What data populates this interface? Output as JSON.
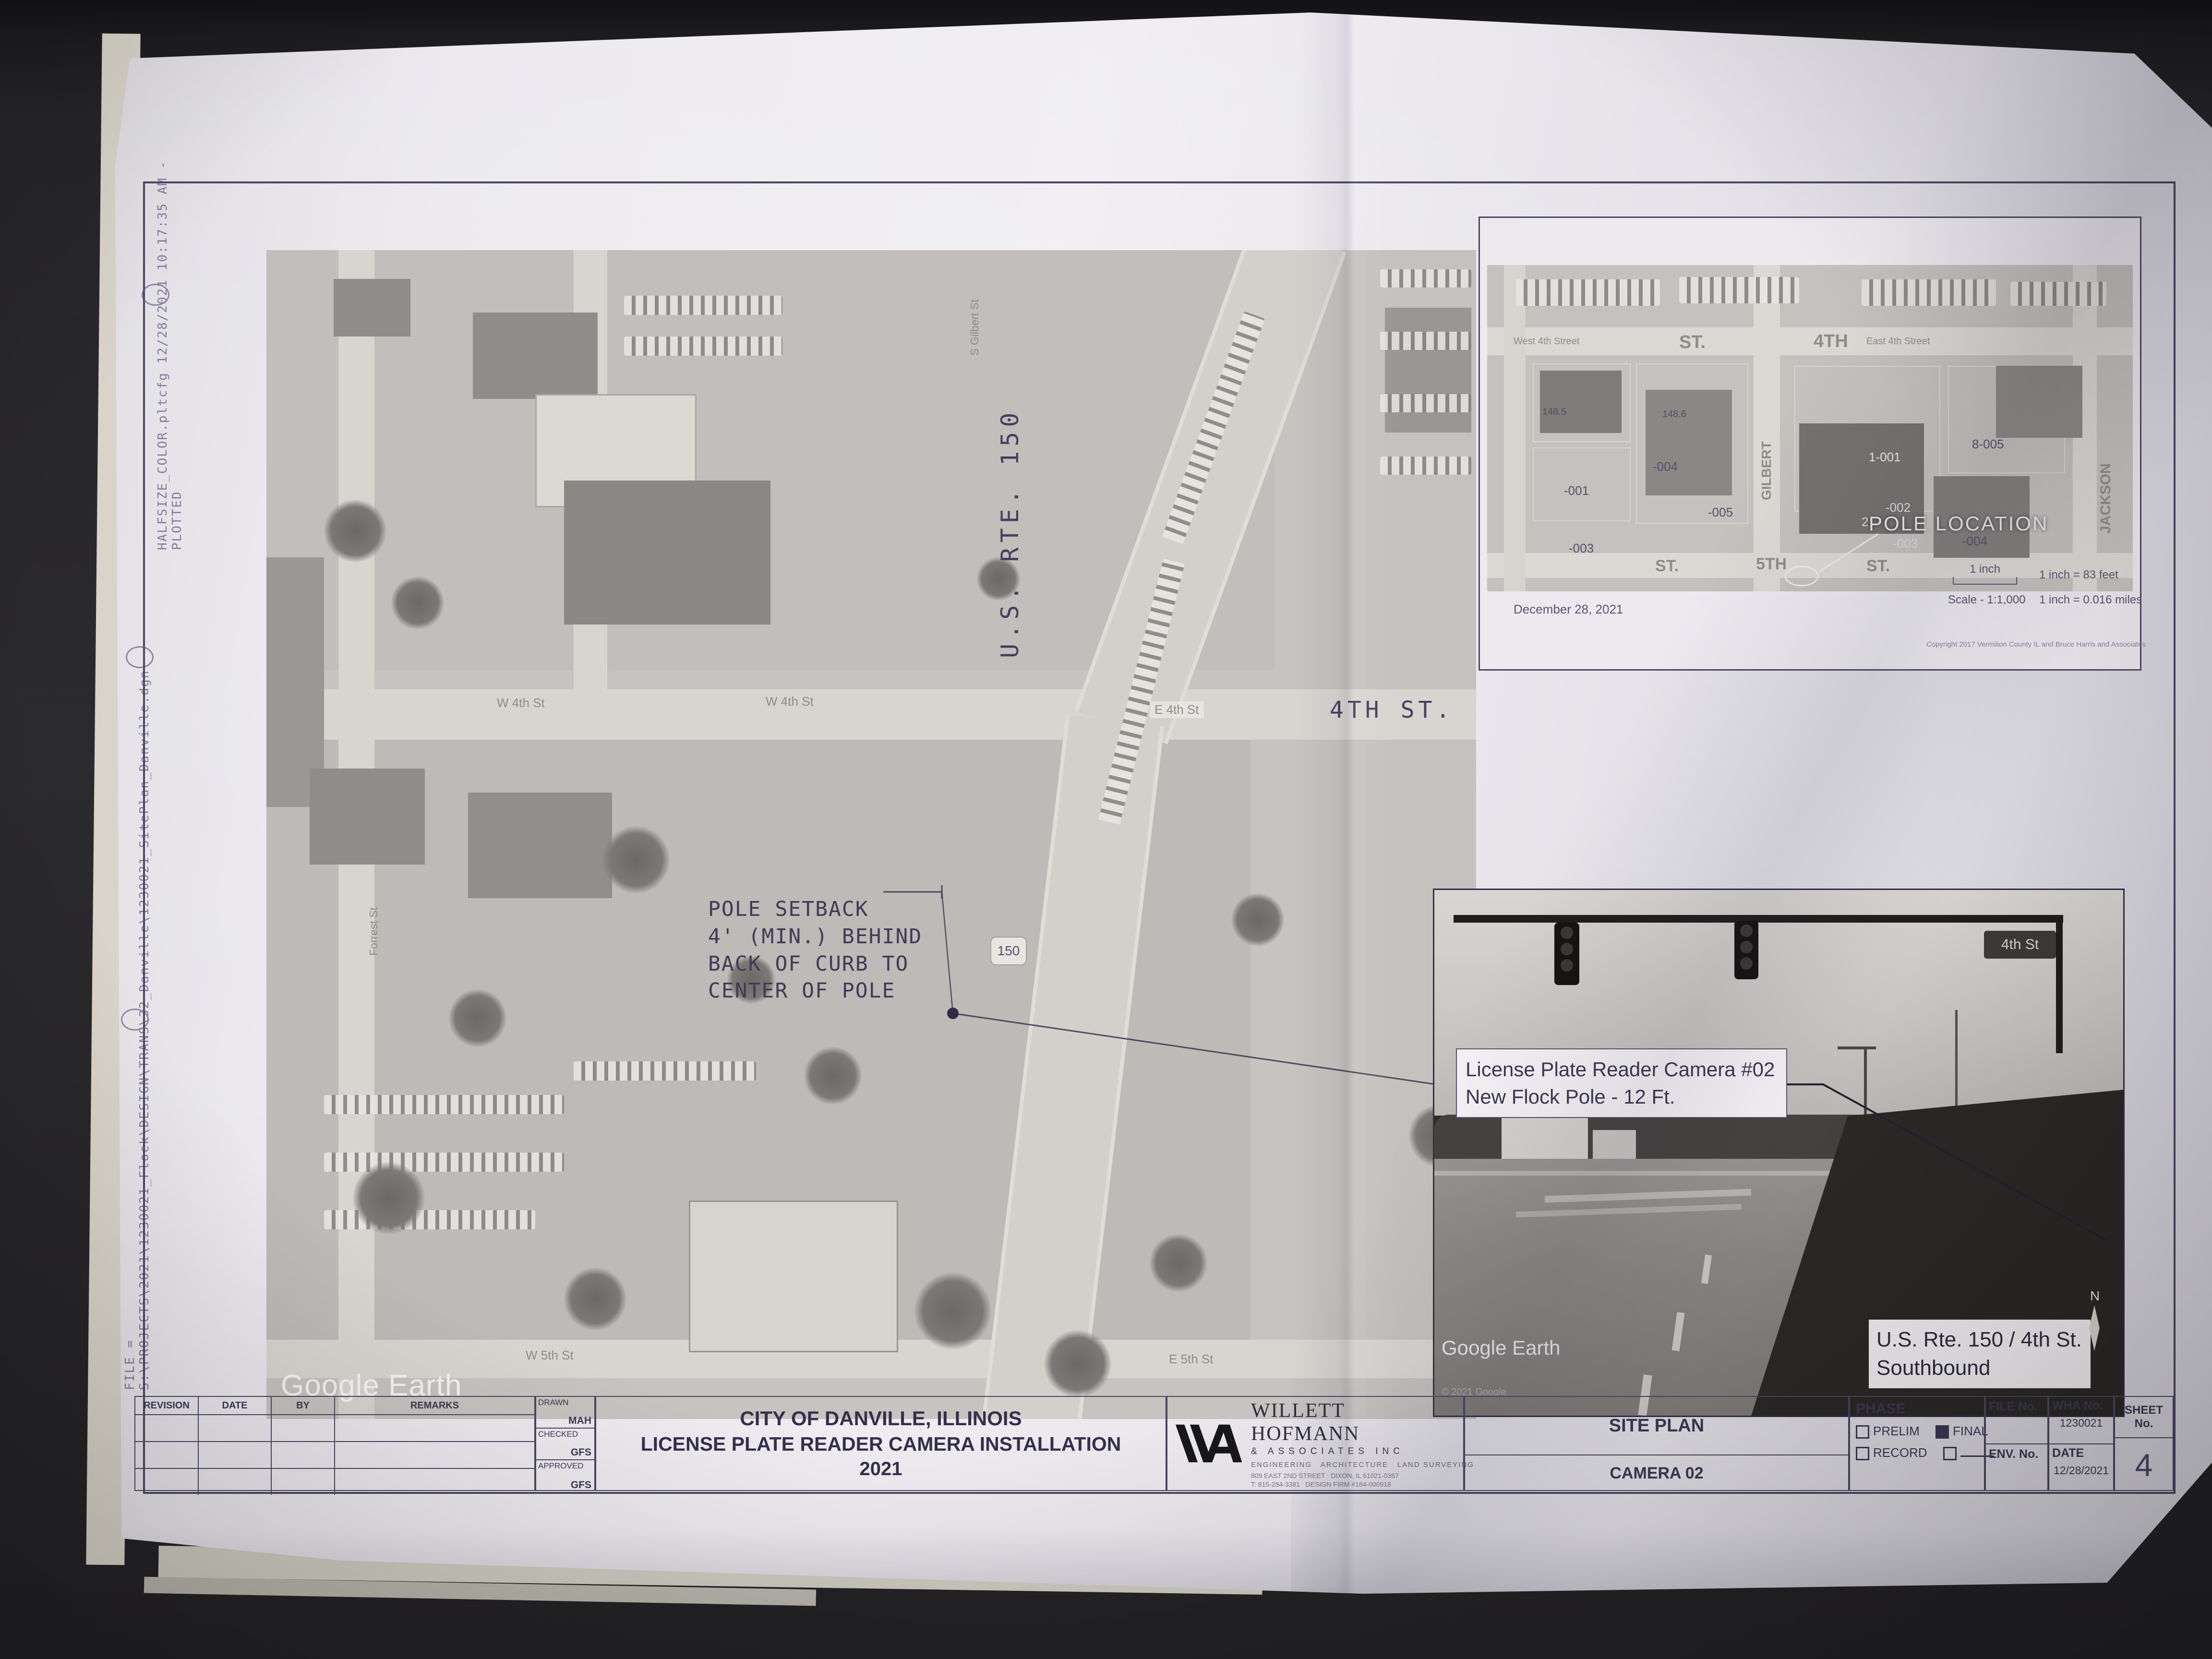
{
  "plot_stamp": {
    "file_line": "FILE = S:\\PROJECTS\\2021\\1230021_Flock\\DESIGN\\TRANS\\32_Danville\\1230021_SitePlan_Danville.dgn",
    "plot_line": "HALFSIZE_COLOR.pltcfg  12/28/2021  10:17:35 AM - PLOTTED"
  },
  "main_map": {
    "watermark": "Google Earth",
    "route_label": "U.S. RTE. 150",
    "route_shield": "150",
    "street_4th": "4TH ST.",
    "street_e4th": "E 4th St",
    "street_w4th": "W 4th St",
    "street_w4th_b": "W 4th St",
    "street_w5th": "W 5th St",
    "street_e5th": "E 5th St",
    "street_gilbert": "S Gilbert St",
    "street_forrest": "Forrest St",
    "pole_note_l1": "POLE SETBACK",
    "pole_note_l2": "4' (MIN.) BEHIND",
    "pole_note_l3": "BACK OF CURB TO",
    "pole_note_l4": "CENTER OF POLE"
  },
  "inset_map": {
    "pole_location": "POLE LOCATION",
    "date": "December 28, 2021",
    "scale_bar_label": "1 inch",
    "scale_ratio": "Scale - 1:1,000",
    "scale_feet": "1 inch = 83 feet",
    "scale_miles": "1 inch = 0.016 miles",
    "copyright": "Copyright 2017 Vermilion County IL and Bruce Harris and Associates",
    "streets": {
      "west4": "West 4th Street",
      "east4": "East 4th Street",
      "st1": "ST.",
      "s4th": "4TH",
      "st2": "ST.",
      "s5th": "5TH",
      "st3": "ST.",
      "jackson": "JACKSON",
      "gilbert": "GILBERT"
    },
    "parcels": [
      "148.5",
      "148.6",
      "-001",
      "-003",
      "-004",
      "-005",
      "1-001",
      "8-005",
      "-002",
      "2",
      "-003",
      "-004"
    ]
  },
  "photo_inset": {
    "callout_l1": "License Plate Reader Camera #02",
    "callout_l2": "New Flock Pole - 12 Ft.",
    "location_l1": "U.S. Rte. 150 / 4th St.",
    "location_l2": "Southbound",
    "watermark": "Google Earth",
    "copyright": "© 2021 Google",
    "street_sign": "4th St",
    "north": "N"
  },
  "title_block": {
    "rev_headers": [
      "REVISION",
      "DATE",
      "BY",
      "REMARKS"
    ],
    "drawn_label": "DRAWN",
    "drawn": "MAH",
    "checked_label": "CHECKED",
    "checked": "GFS",
    "approved_label": "APPROVED",
    "approved": "GFS",
    "project_l1": "CITY OF DANVILLE, ILLINOIS",
    "project_l2": "LICENSE PLATE READER CAMERA INSTALLATION",
    "project_l3": "2021",
    "firm_name": "WILLETT HOFMANN",
    "firm_sub": "& ASSOCIATES INC",
    "firm_tagline": "ENGINEERING   ARCHITECTURE   LAND SURVEYING",
    "firm_addr1": "809 EAST 2ND STREET   DIXON, IL 61021-0367",
    "firm_addr2": "T: 815-284-3381   DESIGN FIRM #184-000918",
    "sheet_title": "SITE PLAN",
    "sheet_subtitle": "CAMERA 02",
    "phase_label": "PHASE",
    "phase_prelim": "PRELIM",
    "phase_final": "FINAL",
    "phase_record": "RECORD",
    "phase_states": {
      "prelim": false,
      "final": true,
      "record": false,
      "other": false
    },
    "file_no_label": "FILE No.",
    "env_no_label": "ENV. No.",
    "wha_no_label": "WHA No.",
    "wha_no": "1230021",
    "date_label": "DATE",
    "date": "12/28/2021",
    "sheet_no_label": "SHEET No.",
    "sheet_no": "4"
  }
}
